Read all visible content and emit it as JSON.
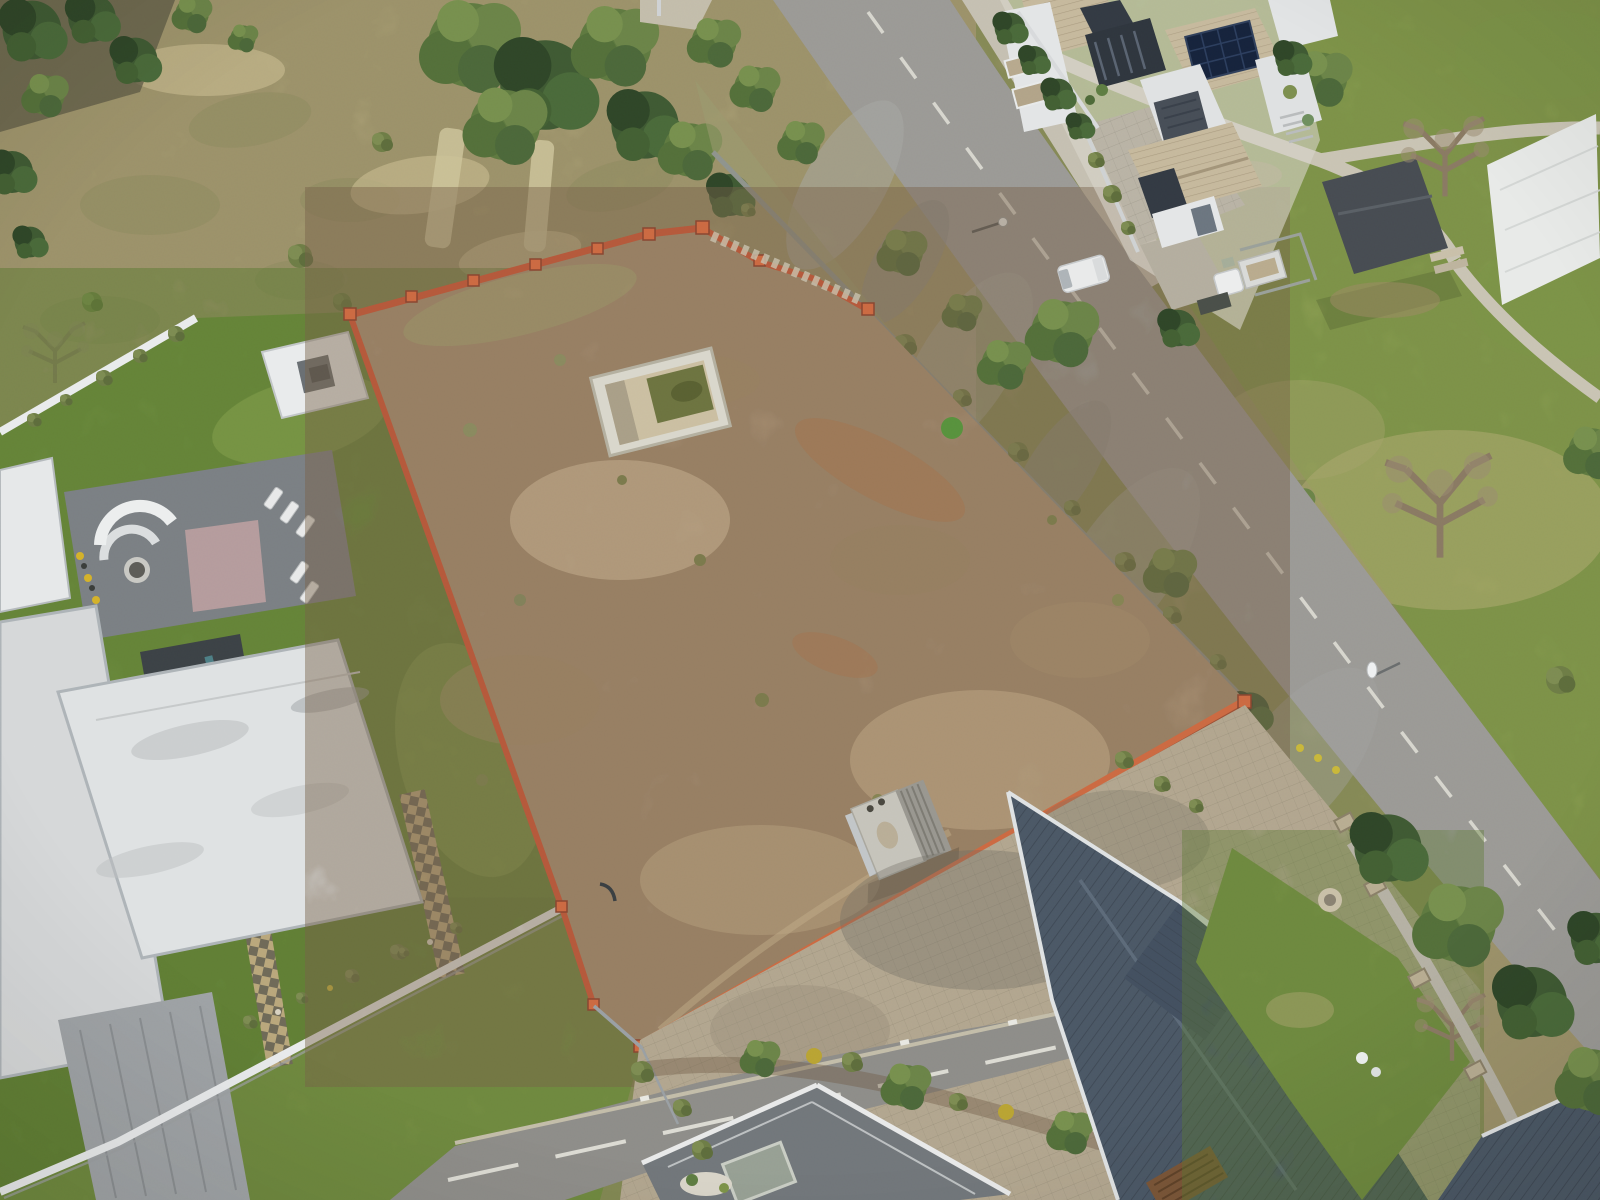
{
  "scene": {
    "type": "aerial-drone-photograph",
    "description": "Top-down aerial drone view of a vacant walled residential stand with an empty sunken pool pit, surrounded by modern luxury houses, a curving suburban road and golf-course lawns",
    "season": "dry winter"
  },
  "colors": {
    "field": "#b1a57b",
    "plot_dirt": "#b0977a",
    "lawn": "#6f8f3f",
    "verge": "#8e9960",
    "golf": "#8fa054",
    "road": "#9b9a96",
    "street": "#8e8d89",
    "pavers": "#b2a68f",
    "driveway_pavers": "#b9b3a5",
    "sidewalk": "#c5c0b2",
    "brick_wall": "#b5593b",
    "brick_wall_bright": "#cc6a42",
    "white_wall": "#e9ebec",
    "white_roof": "#dfe2e3",
    "white_roof_low": "#d6d8d9",
    "gray_roof": "#72777b",
    "dark_roof": "#4b5866",
    "dark_roof_gable": "#435060",
    "tile_roof": "#c6b99d",
    "slate": "#333a43",
    "solar_panel": "#16233c",
    "deck": "#7b8084",
    "pink_mat": "#c0a1a1",
    "tarp": "#e8eae8",
    "shed_roof": "#474c52",
    "plot_shed": "#c6c4bb",
    "plot_shed_dark": "#999790",
    "fence": "#8f948d",
    "pit_rim": "#d9d7cc",
    "pit_floor": "#cbbfa2",
    "pit_water": "#6d7440",
    "sand": "#c2a87c",
    "tree_green": "#557841",
    "tree_dark": "#3f5a33",
    "tree_olive": "#6b8448",
    "bush": "#6e7d46",
    "bare_tree": "#8a7a63",
    "marking": "#dcdbd3",
    "vehicle_white": "#e9eaea",
    "mulch": "#6f5a44",
    "yellow_bush": "#b9a433",
    "chimney_brick": "#8a5f41",
    "pergola_wood": "#7a5638",
    "skylight": "#97a094"
  },
  "objects": [
    {
      "name": "vacant-plot",
      "label": "fenced vacant dirt stand"
    },
    {
      "name": "pool-pit",
      "label": "empty sunken pool with green water"
    },
    {
      "name": "plot-shed",
      "label": "small weathered shed against boundary wall"
    },
    {
      "name": "brick-boundary-wall",
      "label": "orange face-brick boundary wall with pillars"
    },
    {
      "name": "left-house",
      "label": "modern flat-roof house with roof deck and lawn"
    },
    {
      "name": "top-right-house",
      "label": "double-storey house with solar panels"
    },
    {
      "name": "bottom-right-house",
      "label": "house with dark standing-seam metal roof"
    },
    {
      "name": "main-road",
      "label": "curving suburban road with dashed centre line"
    },
    {
      "name": "bottom-street",
      "label": "lower access street"
    },
    {
      "name": "golf-course",
      "label": "golf-course lawns with cart paths and covered green"
    },
    {
      "name": "white-tarp",
      "label": "large white ground cover sheet"
    },
    {
      "name": "wild-field",
      "label": "dry veld with bush and trees"
    }
  ]
}
